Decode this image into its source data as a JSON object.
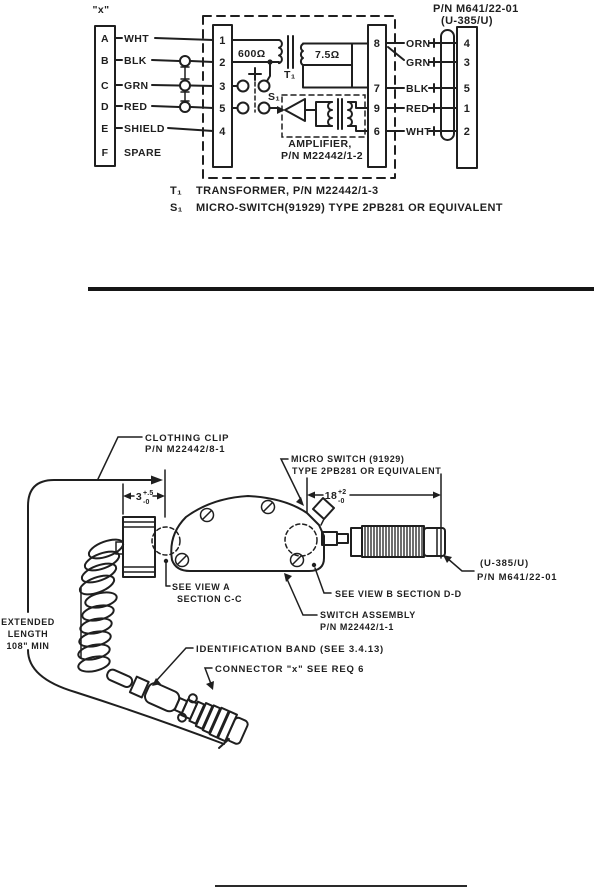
{
  "page": {
    "bg": "#ffffff",
    "ink": "#1f1f1f"
  },
  "schematic": {
    "connector_label": "\"x\"",
    "rows": [
      {
        "pin": "A",
        "wire": "WHT"
      },
      {
        "pin": "B",
        "wire": "BLK"
      },
      {
        "pin": "C",
        "wire": "GRN"
      },
      {
        "pin": "D",
        "wire": "RED"
      },
      {
        "pin": "E",
        "wire": "SHIELD"
      },
      {
        "pin": "F",
        "wire": "SPARE"
      }
    ],
    "module_pins_left": [
      "1",
      "2",
      "3",
      "5",
      "4"
    ],
    "module_pins_right": [
      "8",
      "7",
      "9",
      "6"
    ],
    "primary_impedance": "600Ω",
    "secondary_impedance": "7.5Ω",
    "transformer_ref": "T₁",
    "switch_ref": "S₁",
    "amplifier_line1": "AMPLIFIER,",
    "amplifier_line2": "P/N M22442/1-2",
    "plug_title_line1": "P/N M641/22-01",
    "plug_title_line2": "(U-385/U)",
    "plug_rows": [
      {
        "wire": "ORN",
        "pin": "4"
      },
      {
        "wire": "GRN",
        "pin": "3"
      },
      {
        "wire": "BLK",
        "pin": "5"
      },
      {
        "wire": "RED",
        "pin": "1"
      },
      {
        "wire": "WHT",
        "pin": "2"
      }
    ],
    "note1_ref": "T₁",
    "note1_text": "TRANSFORMER, P/N M22442/1-3",
    "note2_ref": "S₁",
    "note2_text": "MICRO-SWITCH(91929) TYPE 2PB281 OR EQUIVALENT"
  },
  "drawing": {
    "clothing_clip_line1": "CLOTHING CLIP",
    "clothing_clip_line2": "P/N M22442/8-1",
    "micro_switch_line1": "MICRO SWITCH (91929)",
    "micro_switch_line2": "TYPE 2PB281 OR EQUIVALENT",
    "clip_dim_value": "3",
    "clip_dim_plus": "+.5",
    "clip_dim_minus": "-0",
    "plug_dim_value": "18",
    "plug_dim_plus": "+2",
    "plug_dim_minus": "-0",
    "plug_label_line1": "(U-385/U)",
    "plug_label_line2": "P/N M641/22-01",
    "view_a_line1": "SEE VIEW A",
    "view_a_line2": "SECTION C-C",
    "view_b": "SEE VIEW B SECTION D-D",
    "switch_assembly_line1": "SWITCH ASSEMBLY",
    "switch_assembly_line2": "P/N M22442/1-1",
    "extended_line1": "EXTENDED",
    "extended_line2": "LENGTH",
    "extended_line3": "108\" MIN",
    "identification_band": "IDENTIFICATION BAND (SEE 3.4.13)",
    "connector_x": "CONNECTOR \"x\" SEE REQ 6"
  }
}
